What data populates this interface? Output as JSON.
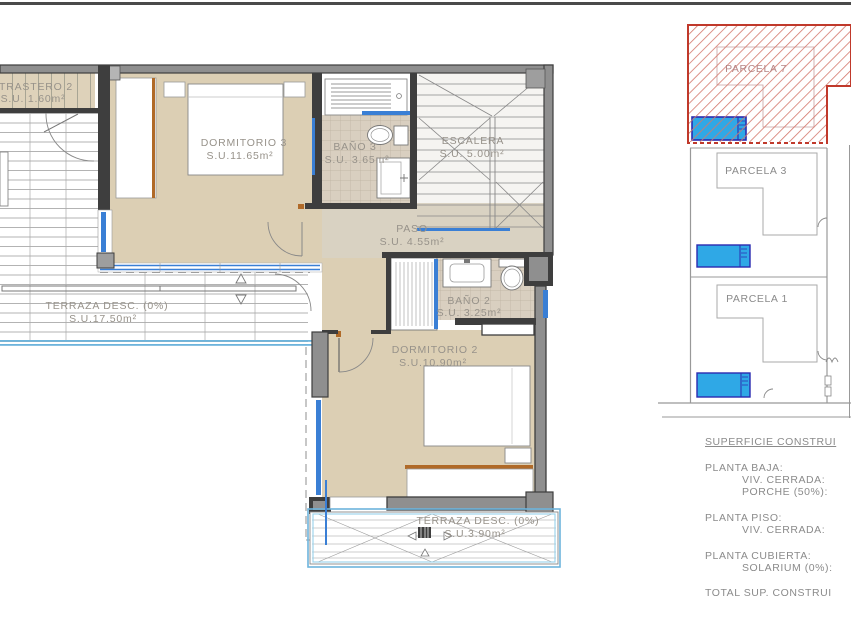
{
  "floor_plan": {
    "rooms": {
      "trastero2": {
        "name": "TRASTERO 2",
        "area": "S.U. 1.60m²"
      },
      "dormitorio3": {
        "name": "DORMITORIO 3",
        "area": "S.U.11.65m²"
      },
      "bano3": {
        "name": "BAÑO 3",
        "area": "S.U. 3.65m²"
      },
      "escalera": {
        "name": "ESCALERA",
        "area": "S.U. 5.00m²"
      },
      "paso": {
        "name": "PASO",
        "area": "S.U. 4.55m²"
      },
      "bano2": {
        "name": "BAÑO 2",
        "area": "S.U. 3.25m²"
      },
      "dormitorio2": {
        "name": "DORMITORIO 2",
        "area": "S.U.10.90m²"
      },
      "terraza_izq": {
        "name": "TERRAZA DESC. (0%)",
        "area": "S.U.17.50m²"
      },
      "terraza_inf": {
        "name": "TERRAZA DESC. (0%)",
        "area": "S.U.3.90m²"
      }
    }
  },
  "site_plan": {
    "parcel7": "PARCELA 7",
    "parcel3": "PARCELA 3",
    "parcel1": "PARCELA 1"
  },
  "summary": {
    "title": "SUPERFICIE CONSTRUI",
    "sections": [
      {
        "heading": "PLANTA BAJA:",
        "lines": [
          "VIV. CERRADA:",
          "PORCHE (50%):"
        ]
      },
      {
        "heading": "PLANTA PISO:",
        "lines": [
          "VIV. CERRADA:"
        ]
      },
      {
        "heading": "PLANTA CUBIERTA:",
        "lines": [
          "SOLARIUM (0%):"
        ]
      }
    ],
    "total": "TOTAL SUP. CONSTRUI"
  },
  "colors": {
    "wall_dark": "#3e3e3e",
    "wall_gray": "#8f8f8f",
    "room_beige": "#dccfb4",
    "hall_beige": "#d9d2c2",
    "tile": "#d9cfc0",
    "window_blue": "#3a7fd5",
    "terrace_blue": "#6db4dc",
    "pool_fill": "#2fa8e6",
    "pool_border": "#2b2bb0",
    "parcel_red": "#c0392b",
    "label_gray": "#97928a",
    "summary_gray": "#8b8b8b",
    "door_jamb_brown": "#b06a28"
  }
}
